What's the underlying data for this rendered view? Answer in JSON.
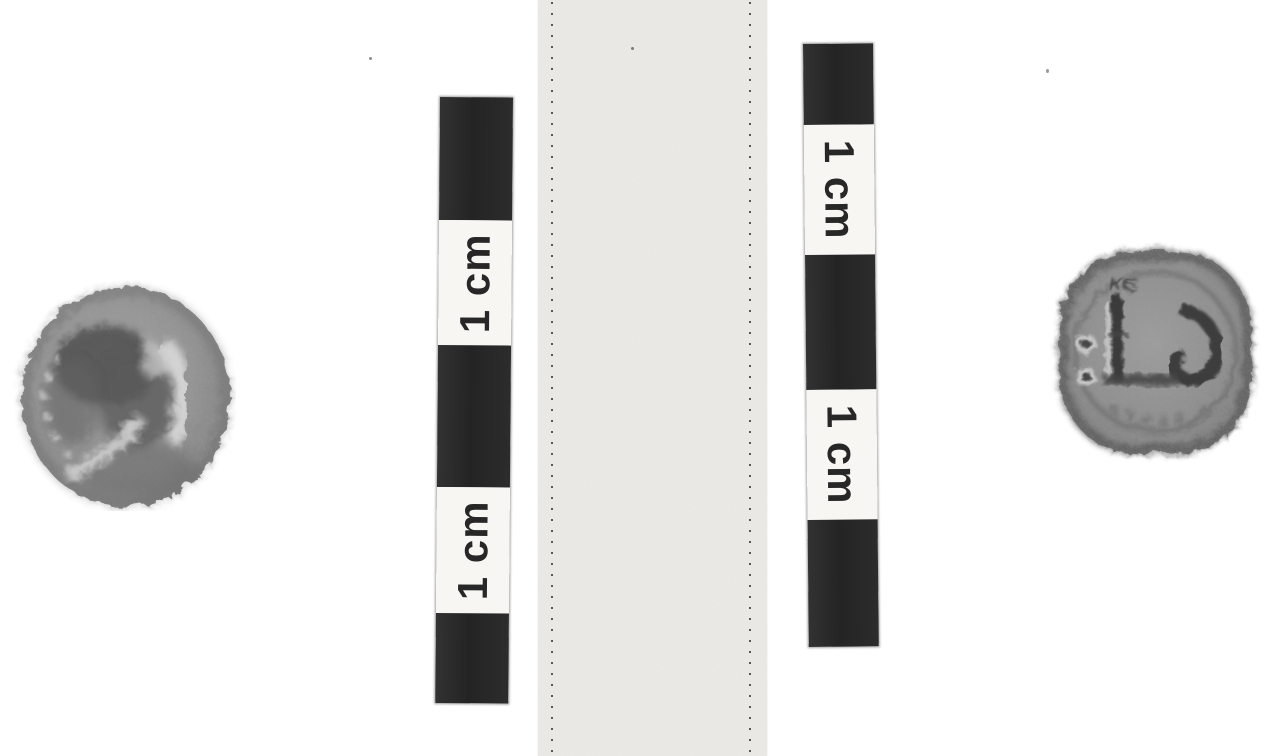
{
  "meta": {
    "media": "black-and-white photograph",
    "subject": "Obverse and reverse of a small worn bronze coin photographed beside centimetre scale bars and a stitched paper strip"
  },
  "scale_bars": {
    "left": {
      "unit_labels": [
        "1 cm",
        "1 cm"
      ],
      "text_direction": "bottom-to-top"
    },
    "right": {
      "unit_labels": [
        "1 cm",
        "1 cm"
      ],
      "text_direction": "top-to-bottom"
    }
  },
  "coins": {
    "left": {
      "side": "obverse",
      "shape": "round",
      "description": "Worn round coin, head in profile with wreath traces"
    },
    "right": {
      "side": "reverse",
      "shape": "rounded-square",
      "inscription": "KE",
      "description": "Coin reverse with mast and prow device, two pellets at left, faint letters below"
    }
  },
  "paper_strip": {
    "description": "Light card strip with two vertical dotted perforation lines"
  },
  "colors": {
    "background": "#ffffff",
    "bar_black": "#282828",
    "label_white": "#f7f6f3",
    "label_text": "#272727",
    "strip": "#ecebe7",
    "coin_gray": "#8f8f8f"
  }
}
